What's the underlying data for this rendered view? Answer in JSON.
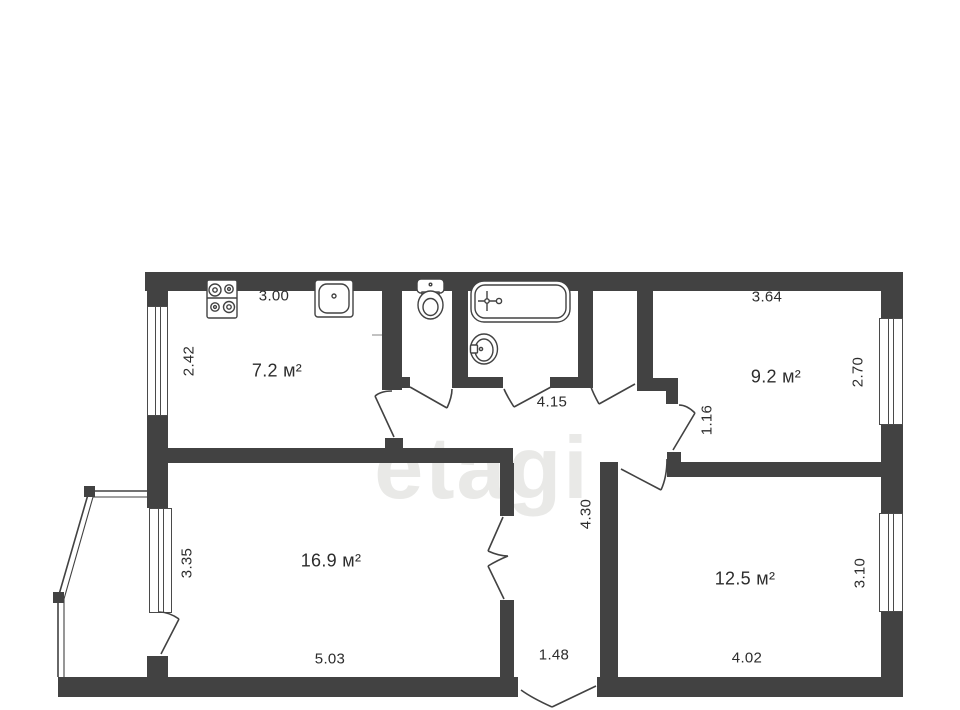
{
  "watermark": "etagi",
  "colors": {
    "wall": "#424242",
    "text": "#2d2d2d",
    "watermark": "#e9e9e7",
    "background": "#ffffff"
  },
  "rooms": {
    "kitchen": {
      "area": "7.2 м²",
      "dim_top": "3.00",
      "dim_side": "2.42"
    },
    "bedroom": {
      "area": "9.2 м²",
      "dim_top": "3.64",
      "dim_side": "2.70",
      "dim_door": "1.16"
    },
    "living": {
      "area": "16.9 м²",
      "dim_bottom": "5.03",
      "dim_side": "3.35"
    },
    "bedroom2": {
      "area": "12.5 м²",
      "dim_bottom": "4.02",
      "dim_side": "3.10"
    },
    "hallway": {
      "dim_width": "4.15",
      "dim_length": "4.30",
      "dim_entry": "1.48"
    }
  },
  "icons": [
    "stove-icon",
    "kitchen-sink-icon",
    "toilet-icon",
    "bathtub-icon",
    "washbasin-icon",
    "window",
    "door-swing",
    "balcony-railing"
  ]
}
